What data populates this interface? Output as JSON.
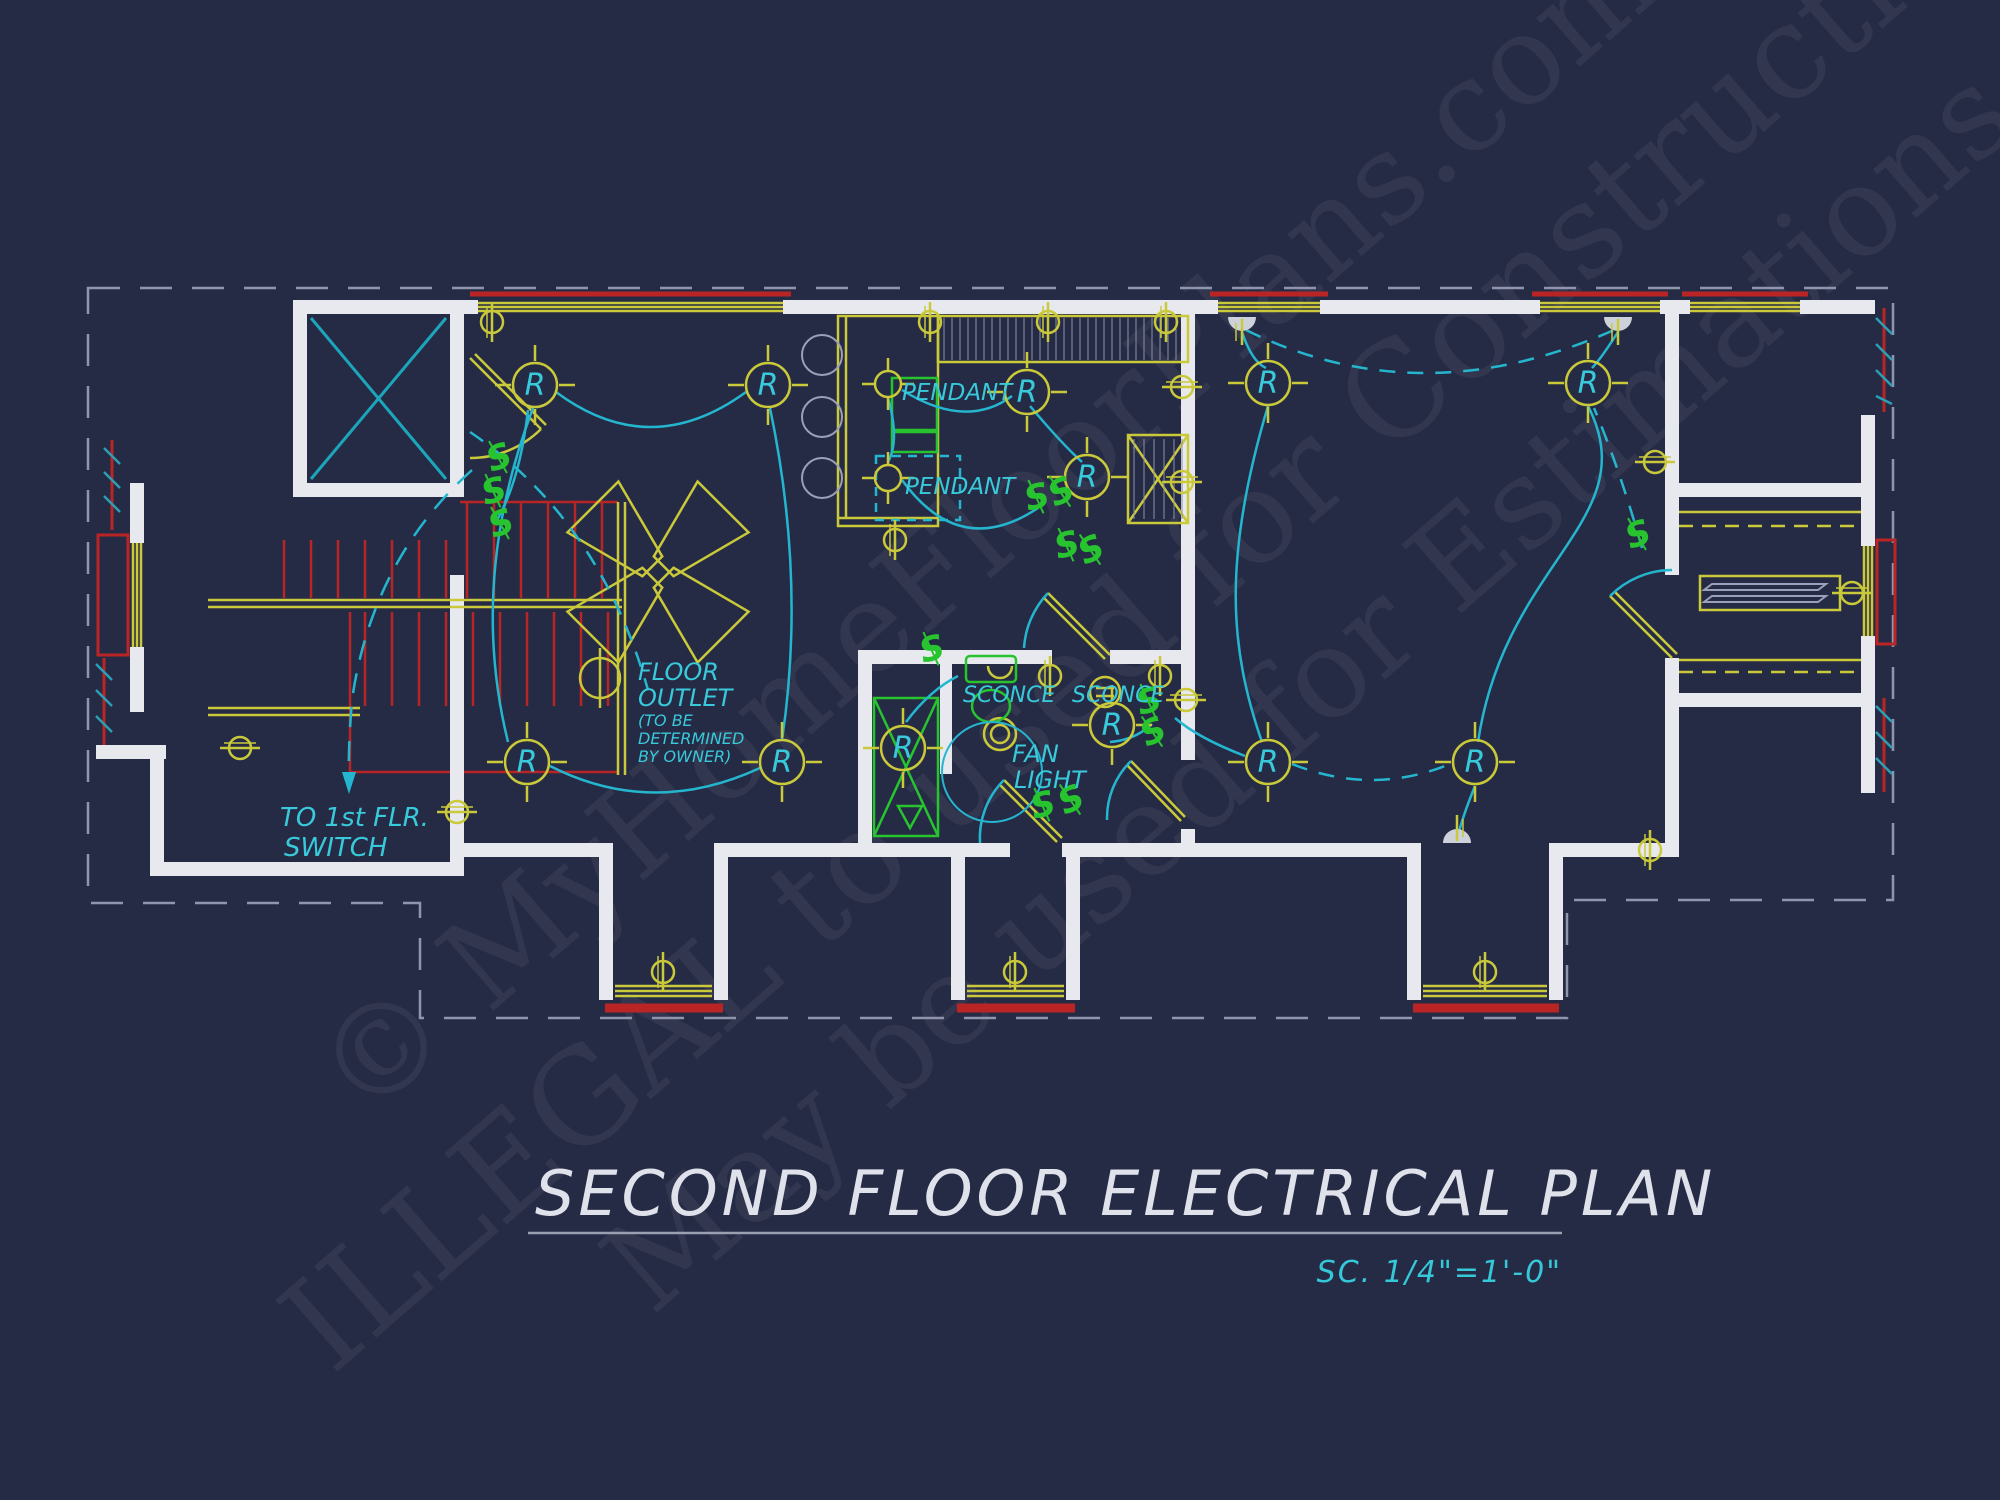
{
  "title": {
    "text": "SECOND FLOOR ELECTRICAL PLAN",
    "scale_label": "SC. 1/4\"=1'-0\""
  },
  "watermarks": {
    "line1": "© MyHomeFloorPlans.com",
    "line2": "ILLEGAL to used for Construction",
    "line3": "May be used for Estimations"
  },
  "annotations": {
    "pendant_upper": "PENDANT",
    "pendant_lower": "PENDANT",
    "sconce_left": "SCONCE",
    "sconce_right": "SCONCE",
    "fan_light_line1": "FAN",
    "fan_light_line2": "LIGHT",
    "floor_outlet_line1": "FLOOR",
    "floor_outlet_line2": "OUTLET",
    "floor_outlet_line3": "(TO BE",
    "floor_outlet_line4": "DETERMINED",
    "floor_outlet_line5": "BY OWNER)",
    "stair_note_line1": "TO 1st FLR.",
    "stair_note_line2": "SWITCH"
  },
  "symbols": {
    "recessed_light_letter": "R",
    "switch_letter": "S"
  },
  "colors": {
    "background": "#262b45",
    "walls": "#e8e9ee",
    "electrical_yellow": "#c9c93a",
    "wiring_cyan": "#25b6cf",
    "fixture_green": "#27c42f",
    "accent_red": "#b92525",
    "label_cyan": "#38c9da",
    "title_text": "#dfe2ea"
  }
}
